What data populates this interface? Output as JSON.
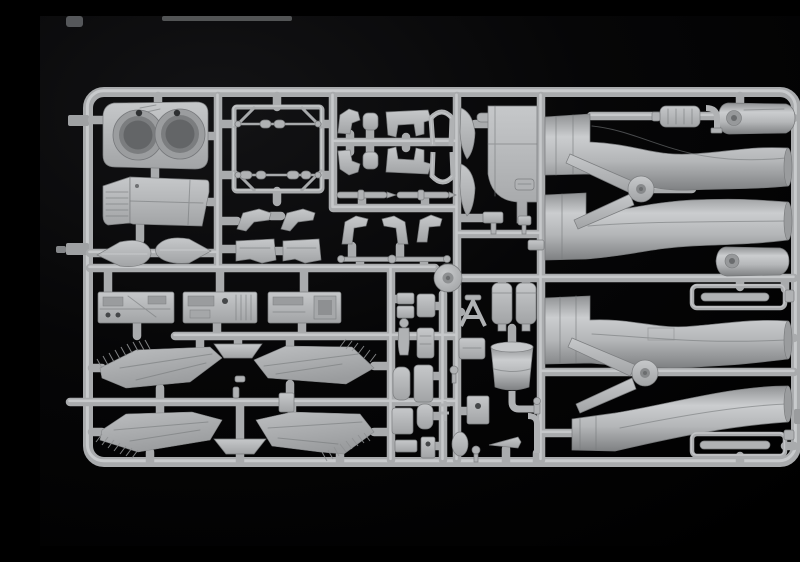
{
  "scene": {
    "subject": "Injection-molded model kit sprue of light gray aircraft parts photographed on a black background",
    "material": "light gray polystyrene plastic",
    "background": "black studio backdrop with faint upper-left glow"
  },
  "colors": {
    "background": "#000000",
    "backgroundGlow": "#121214",
    "plastic": "#b0b2b4",
    "plasticLight": "#d3d5d6",
    "plasticDark": "#8b8d8f",
    "plasticDeep": "#5f6163",
    "holeShadow": "#454749",
    "runner": "#a9abad",
    "runnerHighlight": "#cbcdcf"
  },
  "parts": [
    {
      "name": "sprue-frame",
      "desc": "rounded rectangular runner frame with clamp tabs"
    },
    {
      "name": "runner-grid",
      "desc": "internal runner bars dividing the sprue into bays"
    },
    {
      "name": "exhaust-housing",
      "desc": "rear fuselage block with twin circular exhaust openings"
    },
    {
      "name": "spine-panel",
      "desc": "upper fuselage spine panel with ribbed forward edge"
    },
    {
      "name": "drop-tank-half-left",
      "desc": "teardrop external tank half, point facing left"
    },
    {
      "name": "drop-tank-half-right",
      "desc": "teardrop external tank half, point facing right"
    },
    {
      "name": "equipment-rack-frame",
      "desc": "rectangular lattice frame with corner gussets and capsule fittings"
    },
    {
      "name": "angled-brackets-left",
      "desc": "pair of angular bracket parts with console boxes"
    },
    {
      "name": "ejection-seat-parts",
      "desc": "ejection seat sides, cushions and seat frames in two rows"
    },
    {
      "name": "canopy-arches",
      "desc": "two horseshoe-shaped canopy frame arches"
    },
    {
      "name": "pylon-rails",
      "desc": "two slender finned pylon/rail parts"
    },
    {
      "name": "angled-brackets-right",
      "desc": "three angular brackets and a slender linkage rod"
    },
    {
      "name": "console-panel-1",
      "desc": "cockpit side console panel"
    },
    {
      "name": "console-panel-2",
      "desc": "cockpit side console panel with slatted detail"
    },
    {
      "name": "console-panel-3",
      "desc": "cockpit side console panel with square bay"
    },
    {
      "name": "wing-upper-left",
      "desc": "swept wing panel with feathered slat edge"
    },
    {
      "name": "wing-upper-right",
      "desc": "swept wing panel with feathered slat edge"
    },
    {
      "name": "wing-lower-left",
      "desc": "swept wing panel with feathered slat edge"
    },
    {
      "name": "wing-lower-right",
      "desc": "swept wing panel with feathered slat edge"
    },
    {
      "name": "flap-segment-top",
      "desc": "small trapezoidal flap segment"
    },
    {
      "name": "flap-segment-bottom",
      "desc": "small trapezoidal flap segment"
    },
    {
      "name": "parts-disc",
      "desc": "circular disc part with center bore"
    },
    {
      "name": "pilot-figure",
      "desc": "small standing crew figure"
    },
    {
      "name": "small-boxes-column",
      "desc": "column of small box and pad parts"
    },
    {
      "name": "windscreen-blades",
      "desc": "two curved windscreen frame halves"
    },
    {
      "name": "cockpit-bulkhead",
      "desc": "stepped cockpit bulkhead panel with fitting"
    },
    {
      "name": "stand-parts",
      "desc": "small T-stand parts on lower runner"
    },
    {
      "name": "ladder-frame",
      "desc": "small A-frame ladder part"
    },
    {
      "name": "avionics-canisters",
      "desc": "pair of capped rectangular canisters"
    },
    {
      "name": "intake-trunk-drum",
      "desc": "tapered drum section with elbow pipe"
    },
    {
      "name": "detail-plate-cluster",
      "desc": "plates, oval pad, cone and elbow fittings"
    },
    {
      "name": "wing-pivot-upper",
      "desc": "wing sweep pivot mechanism with round boss"
    },
    {
      "name": "wing-pivot-lower",
      "desc": "wing sweep pivot mechanism with round boss"
    },
    {
      "name": "intake-duct-upper-a",
      "desc": "S-curved intake trunk half"
    },
    {
      "name": "intake-duct-upper-b",
      "desc": "S-curved intake trunk half"
    },
    {
      "name": "intake-duct-lower-a",
      "desc": "S-curved intake trunk half"
    },
    {
      "name": "intake-duct-lower-b",
      "desc": "S-curved intake trunk half"
    },
    {
      "name": "intake-lip-upper",
      "desc": "rounded intake lip with circular boss"
    },
    {
      "name": "intake-lip-lower",
      "desc": "rounded intake lip with circular boss"
    },
    {
      "name": "ramp-rails-upper",
      "desc": "nested thin intake ramp rails"
    },
    {
      "name": "ramp-rails-lower",
      "desc": "nested thin intake ramp rails"
    },
    {
      "name": "canister-elbow-top",
      "desc": "small canister and elbow pipe fittings"
    }
  ]
}
